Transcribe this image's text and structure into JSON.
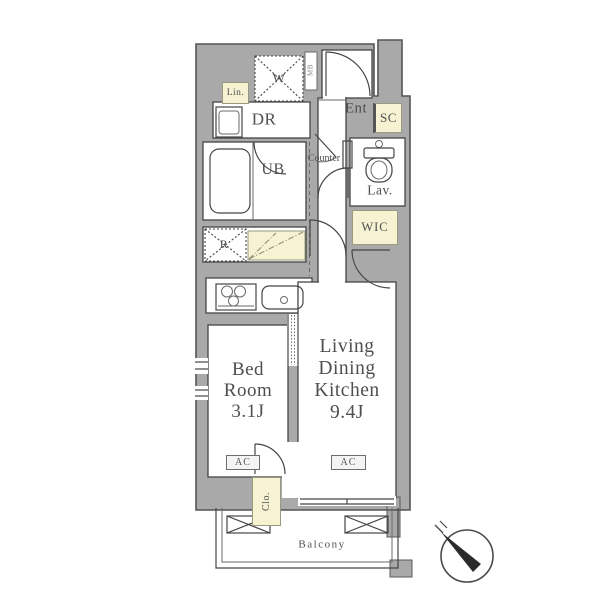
{
  "floorplan": {
    "labels": {
      "lin": "Lin.",
      "washer": "W",
      "dr": "DR",
      "mb": "MB",
      "ent": "Ent",
      "sc": "SC",
      "counter": "Counter",
      "ub": "UB",
      "lav": "Lav.",
      "wic": "WIC",
      "fridge": "R",
      "ac_bedroom": "AC",
      "ac_ldk": "AC",
      "clo": "Clo.",
      "balcony": "Balcony"
    },
    "rooms": {
      "bedroom": {
        "line1": "Bed",
        "line2": "Room",
        "size": "3.1J"
      },
      "ldk": {
        "line1": "Living",
        "line2": "Dining",
        "line3": "Kitchen",
        "size": "9.4J"
      }
    },
    "colors": {
      "wall_gray": "#a9a9a9",
      "accent_yellow": "#f6f2d2",
      "line": "#454545",
      "text": "#4f4f4f"
    }
  }
}
